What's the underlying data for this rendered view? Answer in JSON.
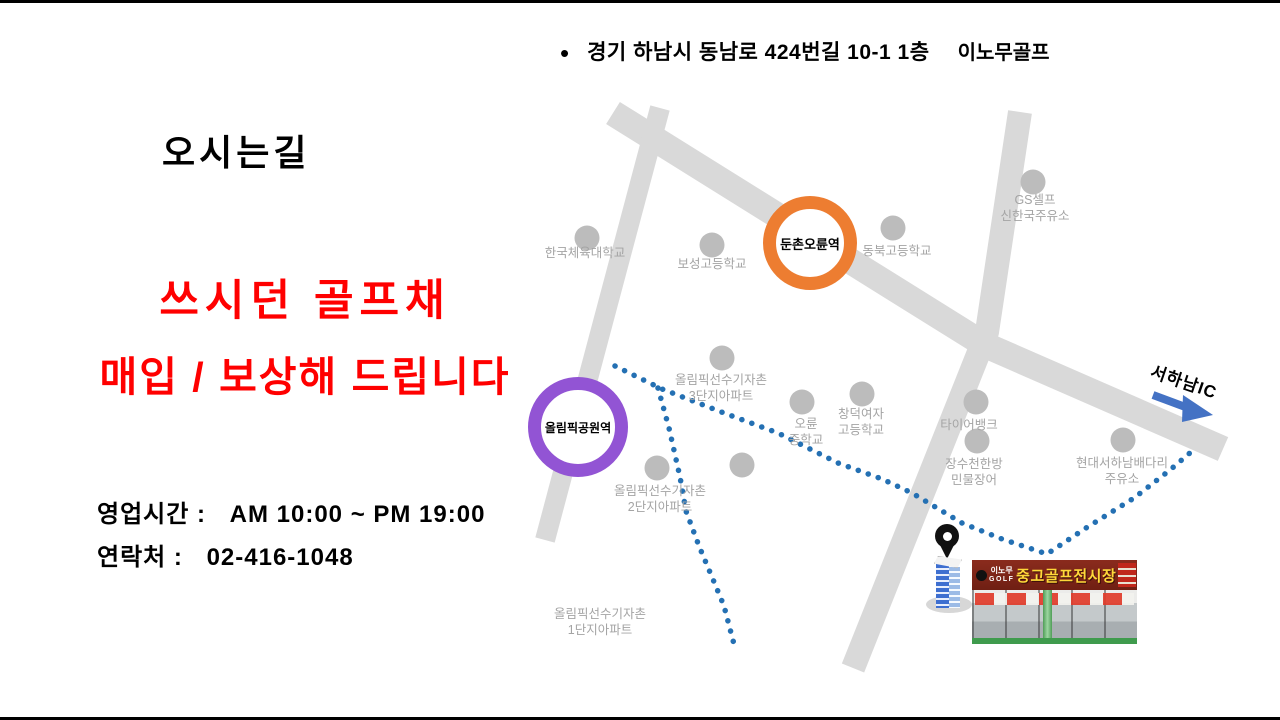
{
  "slide": {
    "address_bullet": "•",
    "address": "경기 하남시 동남로 424번길 10-1 1층",
    "brand": "이노무골프",
    "title": "오시는길",
    "promo": {
      "line1": "쓰시던 골프채",
      "line2": "매입 / 보상해 드립니다",
      "color": "#ff0000"
    },
    "hours": {
      "label": "영업시간 :",
      "value": "AM 10:00 ~ PM 19:00"
    },
    "contact": {
      "label": "연락처 :",
      "value": "02-416-1048"
    }
  },
  "map": {
    "colors": {
      "road": "#d9d9d9",
      "route_dotted": "#2470b3",
      "poi_dot": "#bcbcbc",
      "poi_label_text": "#a4a4a4",
      "station_orange": "#ed7d31",
      "station_purple": "#9254d4",
      "arrow_blue": "#4472c4",
      "promo_red": "#ff0000"
    },
    "stations": [
      {
        "name": "둔촌오륜역"
      },
      {
        "name": "올림픽공원역"
      }
    ],
    "highway": {
      "label": "서하남IC"
    },
    "pois": [
      {
        "line1": "한국체육대학교"
      },
      {
        "line1": "보성고등학교"
      },
      {
        "line1": "동북고등학교"
      },
      {
        "line1": "GS셀프",
        "line2": "신한국주유소"
      },
      {
        "line1": "올림픽선수기자촌",
        "line2": "3단지아파트"
      },
      {
        "line1": "오륜",
        "line2": "중학교"
      },
      {
        "line1": "창덕여자",
        "line2": "고등학교"
      },
      {
        "line1": "타이어뱅크"
      },
      {
        "line1": "장수천한방",
        "line2": "민물장어"
      },
      {
        "line1": "현대서하남배다리",
        "line2": "주유소"
      },
      {
        "line1": "올림픽선수기자촌",
        "line2": "2단지아파트"
      },
      {
        "line1": "올림픽선수기자촌",
        "line2": "1단지아파트"
      }
    ],
    "shop_sign": {
      "brand_top": "이노무",
      "brand_bottom": "GOLF",
      "title": "중고골프전시장"
    }
  }
}
